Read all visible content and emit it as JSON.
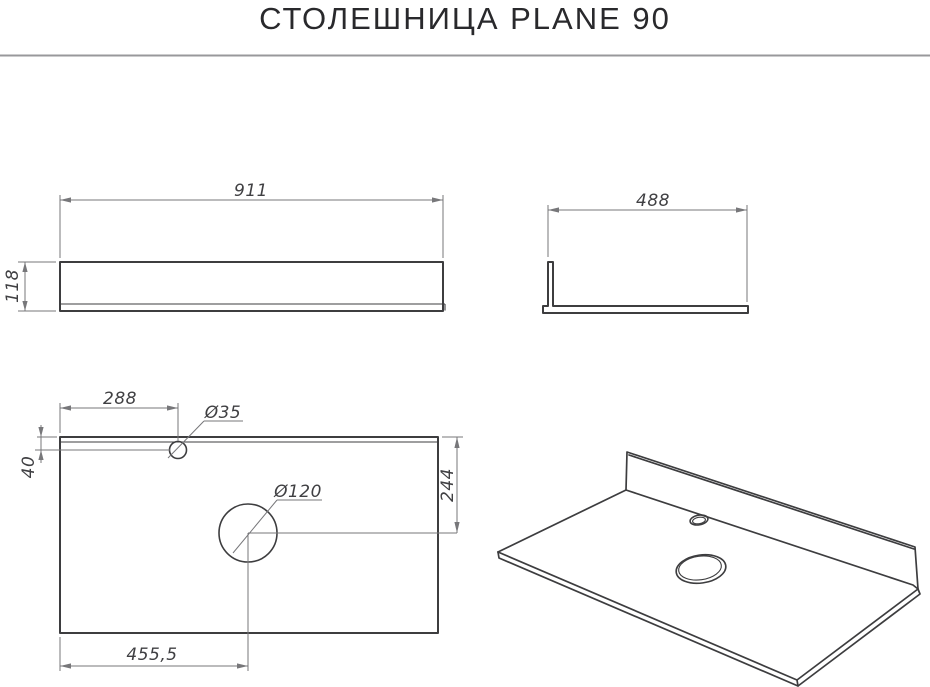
{
  "title": "СТОЛЕШНИЦА PLANE 90",
  "views": {
    "front": {
      "width": "911",
      "height": "118"
    },
    "side": {
      "depth": "488"
    },
    "top": {
      "faucet_offset_x": "288",
      "faucet_diameter": "Ø35",
      "faucet_offset_y": "40",
      "drain_diameter": "Ø120",
      "drain_offset_y": "244",
      "drain_offset_x": "455,5"
    }
  },
  "colors": {
    "outline": "#3d3d3f",
    "dimension": "#77777a",
    "text": "#404043",
    "title-text": "#29292c",
    "divider": "#98989b",
    "background": "#ffffff"
  }
}
